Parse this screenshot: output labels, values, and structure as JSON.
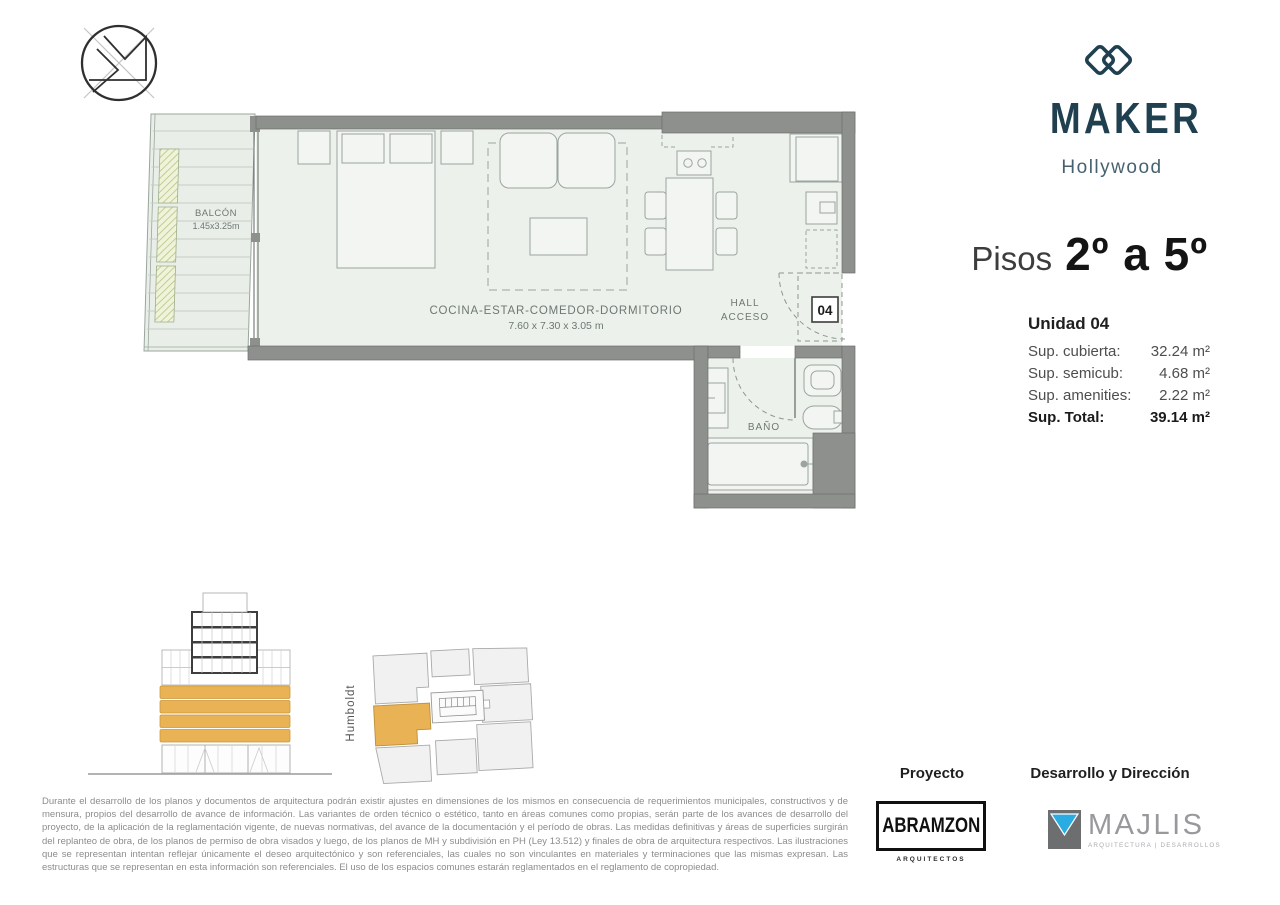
{
  "header": {
    "brand": "MAKER",
    "location": "Hollywood",
    "floors_prefix": "Pisos",
    "floors_range": "2º a 5º"
  },
  "unit": {
    "title": "Unidad 04",
    "rows": [
      {
        "label": "Sup. cubierta:",
        "value": "32.24 m²"
      },
      {
        "label": "Sup. semicub:",
        "value": "4.68 m²"
      },
      {
        "label": "Sup. amenities:",
        "value": "2.22 m²"
      }
    ],
    "total": {
      "label": "Sup. Total:",
      "value": "39.14 m²"
    }
  },
  "plan": {
    "balcony": {
      "label": "BALCÓN",
      "dims": "1.45x3.25m"
    },
    "main_room": {
      "label": "COCINA-ESTAR-COMEDOR-DORMITORIO",
      "dims": "7.60 x 7.30 x 3.05 m"
    },
    "hall": {
      "line1": "HALL",
      "line2": "ACCESO"
    },
    "bath": {
      "label": "BAÑO"
    },
    "unit_number": "04"
  },
  "site": {
    "street": "Humboldt"
  },
  "legal": {
    "disclaimer": "Durante el desarrollo de los planos y documentos de arquitectura podrán existir ajustes en dimensiones de los mismos en consecuencia de requerimientos municipales, constructivos y de mensura, propios del desarrollo de avance de información. Las variantes de orden técnico o estético, tanto en áreas comunes como propias, serán parte de los avances de desarrollo del proyecto, de la aplicación de la reglamentación vigente, de nuevas normativas, del avance de la documentación y el período de obras. Las medidas definitivas y áreas de superficies surgirán del replanteo de obra, de los planos de permiso de obra visados y luego, de los planos de MH y subdivisión en PH (Ley 13.512) y finales de obra de arquitectura respectivos. Las ilustraciones que se representan intentan reflejar únicamente el deseo arquitectónico y son referenciales, las cuales no son vinculantes en materiales y terminaciones que las mismas expresan. Las estructuras que se representan en esta información son referenciales. El uso de los espacios comunes estarán reglamentados en el reglamento de copropiedad."
  },
  "credits": {
    "project_label": "Proyecto",
    "project_name": "ABRAMZON",
    "project_sub": "ARQUITECTOS",
    "dev_label": "Desarrollo y Dirección",
    "dev_name": "MAJLIS",
    "dev_sub": "ARQUITECTURA | DESARROLLOS"
  },
  "colors": {
    "brand_navy": "#20404f",
    "accent_yellow": "#e9b254",
    "wall_gray": "#8e908d",
    "floor_green": "#edf1ec"
  }
}
